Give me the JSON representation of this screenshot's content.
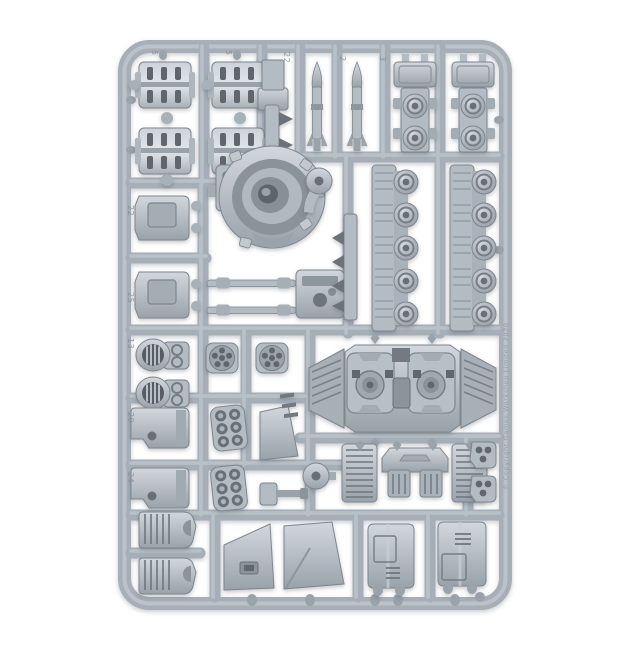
{
  "colors": {
    "background": "#ffffff",
    "rail": "#a6afb8",
    "railLight": "#c7cdd3",
    "railDark": "#858e97",
    "part": "#b3bbc3",
    "partLight": "#d2d7dc",
    "partDark": "#7e868e",
    "slot": "#5f666d",
    "metal": "#ccd2d8"
  },
  "sprue": {
    "frame_numbers": [
      "5",
      "5",
      "22",
      "2",
      "3",
      "22",
      "25",
      "13",
      "20",
      "24"
    ],
    "copyright": "© Copyright Games Workshop Limited 2020",
    "parts": [
      {
        "name": "track-section",
        "count": 4
      },
      {
        "name": "warhead-rack",
        "count": 1
      },
      {
        "name": "missile",
        "count": 2
      },
      {
        "name": "suspension-bogie",
        "count": 2
      },
      {
        "name": "turret-ring",
        "count": 1
      },
      {
        "name": "pivot-disc",
        "count": 2
      },
      {
        "name": "access-hatch",
        "count": 2
      },
      {
        "name": "gun-mount",
        "count": 1
      },
      {
        "name": "axle-rod",
        "count": 2
      },
      {
        "name": "roadwheel-carrier",
        "count": 2
      },
      {
        "name": "hull-roof",
        "count": 1
      },
      {
        "name": "circular-vent",
        "count": 2
      },
      {
        "name": "wheel-hub",
        "count": 2
      },
      {
        "name": "smoke-launcher",
        "count": 2
      },
      {
        "name": "side-panel",
        "count": 2
      },
      {
        "name": "exhaust-wedge",
        "count": 1
      },
      {
        "name": "radiator-grille",
        "count": 2
      },
      {
        "name": "rear-plate",
        "count": 1
      },
      {
        "name": "mount-bracket",
        "count": 2
      },
      {
        "name": "exhaust-vent",
        "count": 2
      },
      {
        "name": "armour-skirt",
        "count": 2
      },
      {
        "name": "hull-side-door",
        "count": 2
      },
      {
        "name": "small-cannon",
        "count": 1
      }
    ]
  }
}
